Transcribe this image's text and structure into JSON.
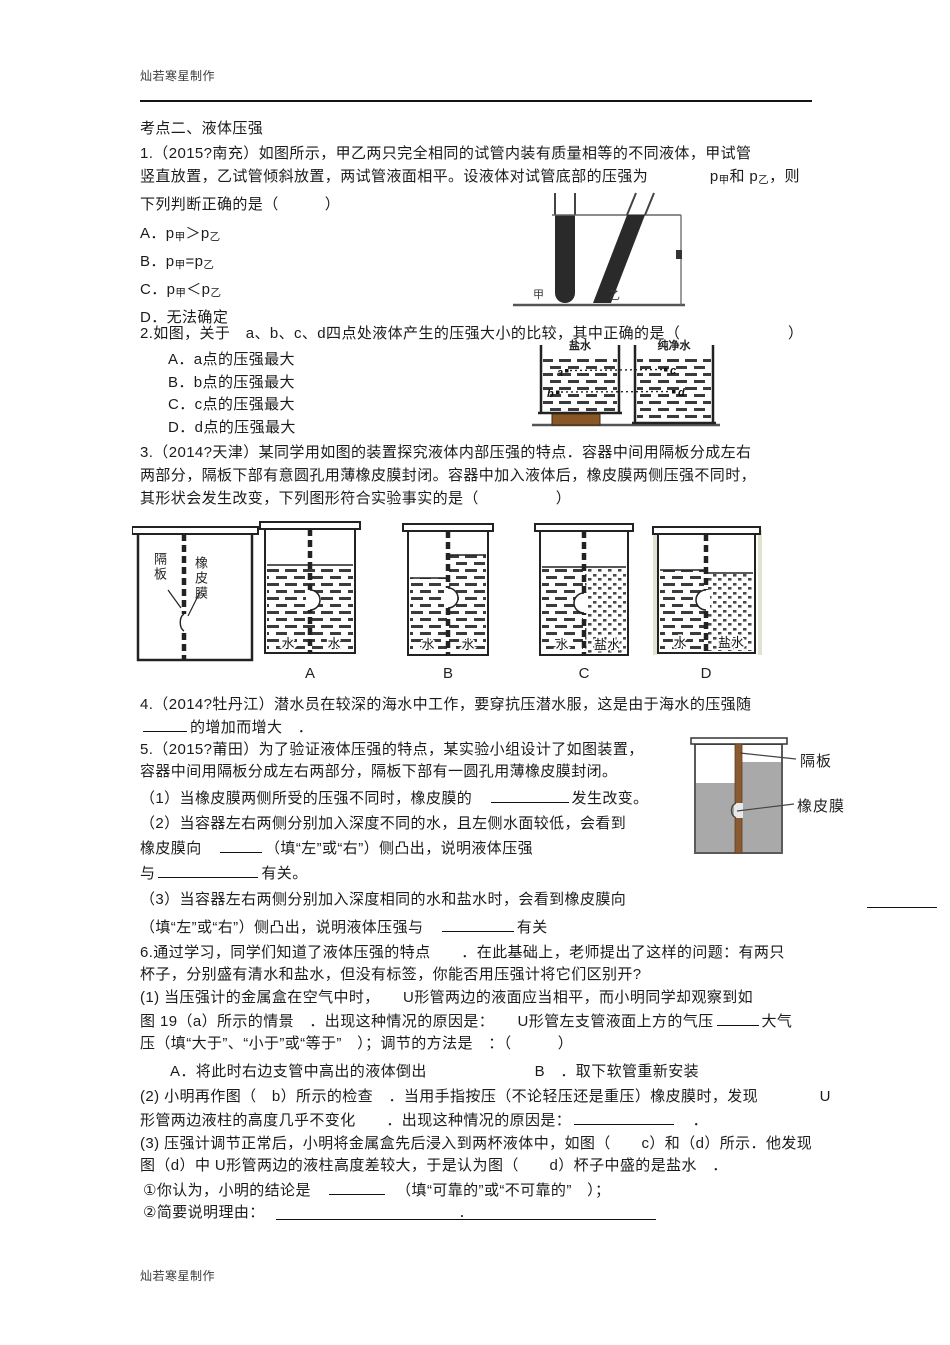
{
  "header": {
    "credit": "灿若寒星制作"
  },
  "footer": {
    "credit": "灿若寒星制作"
  },
  "section": {
    "title": "考点二、液体压强"
  },
  "q1": {
    "line1": "1.（2015?南充）如图所示，甲乙两只完全相同的试管内装有质量相等的不同液体，甲试管",
    "line2_pre": "竖直放置，乙试管倾斜放置，两试管液面相平。设液体对试管底部的压强为　　　　",
    "line2_rich": "p[甲]和 p[乙]，则",
    "line3": "下列判断正确的是（　　　）",
    "optionA": "A．p[甲]＞p[乙]",
    "optionB": "B．p[甲]=p[乙]",
    "optionC": "C．p[甲]＜p[乙]",
    "optionD": "D．无法确定",
    "figure": {
      "jia": "甲",
      "yi": "乙"
    }
  },
  "q2": {
    "line1": "2.如图，关于　a、b、c、d四点处液体产生的压强大小的比较，其中正确的是（　　　　　　　）",
    "optionA": "A．a点的压强最大",
    "optionB": "B．b点的压强最大",
    "optionC": "C．c点的压强最大",
    "optionD": "D．d点的压强最大",
    "figure": {
      "left_title": "盐水",
      "right_title": "纯净水",
      "pa": "a",
      "pb": "b",
      "pc": "c",
      "pd": "d"
    }
  },
  "q3": {
    "line1": "3.（2014?天津）某同学用如图的装置探究液体内部压强的特点．容器中间用隔板分成左右",
    "line2": "两部分，隔板下部有意圆孔用薄橡皮膜封闭。容器中加入液体后，橡皮膜两侧压强不同时，",
    "line3": "其形状会发生改变，下列图形符合实验事实的是（　　　　　）",
    "figure": {
      "geban": "隔板",
      "xpm": "橡皮膜",
      "water": "水",
      "salt": "盐水",
      "labelA": "A",
      "labelB": "B",
      "labelC": "C",
      "labelD": "D"
    }
  },
  "q4": {
    "line1": "4.（2014?牡丹江）潜水员在较深的海水中工作，要穿抗压潜水服，这是由于海水的压强随",
    "line2_post": "的增加而增大　．"
  },
  "q5": {
    "line1": "5.（2015?莆田）为了验证液体压强的特点，某实验小组设计了如图装置，",
    "line2": "容器中间用隔板分成左右两部分，隔板下部有一圆孔用薄橡皮膜封闭。",
    "p1_pre": "（1）当橡皮膜两侧所受的压强不同时，橡皮膜的　",
    "p1_post": "发生改变。",
    "p2_line1": "（2）当容器左右两侧分别加入深度不同的水，且左侧水面较低，会看到",
    "p2_line2_pre": "橡皮膜向　",
    "p2_line2_post": "（填“左”或“右”）侧凸出，说明液体压强",
    "p2_line3_pre": "与",
    "p2_line3_post": "有关。",
    "p3_line1": "（3）当容器左右两侧分别加入深度相同的水和盐水时，会看到橡皮膜向",
    "p3_line2_pre": "（填“左”或“右”）侧凸出，说明液体压强与　",
    "p3_line2_post": "有关",
    "figure": {
      "geban": "隔板",
      "xpm": "橡皮膜"
    }
  },
  "q6": {
    "line1": "6.通过学习，同学们知道了液体压强的特点　　．在此基础上，老师提出了这样的问题：有两只",
    "line2": "杯子，分别盛有清水和盐水，但没有标签，你能否用压强计将它们区别开?",
    "line3": "(1) 当压强计的金属盒在空气中时，　　U形管两边的液面应当相平，而小明同学却观察到如",
    "line4_pre": "图 19（a）所示的情景　．出现这种情况的原因是：　　U形管左支管液面上方的气压",
    "line4_post": "大气",
    "line5": "压（填“大于”、“小于”或“等于”　）；调节的方法是　：（　　　）",
    "line6": "A．将此时右边支管中高出的液体倒出　　　　　　　B　．取下软管重新安装",
    "line7": "(2) 小明再作图（　b）所示的检查　．当用手指按压（不论轻压还是重压）橡皮膜时，发现　　　　U",
    "line8_pre": "形管两边液柱的高度几乎不变化　　．出现这种情况的原因是：",
    "line8_post": "　．",
    "line9": "(3) 压强计调节正常后，小明将金属盒先后浸入到两杯液体中，如图（　　c）和（d）所示．他发现",
    "line10": "图（d）中 U形管两边的液柱高度差较大，于是认为图（　　d）杯子中盛的是盐水　．",
    "s1_pre": "①你认为，小明的结论是　",
    "s1_post": "　（填“可靠的”或“不可靠的”　）；",
    "s2_pre": "②简要说明理由：　",
    "s2_dot": "．"
  }
}
